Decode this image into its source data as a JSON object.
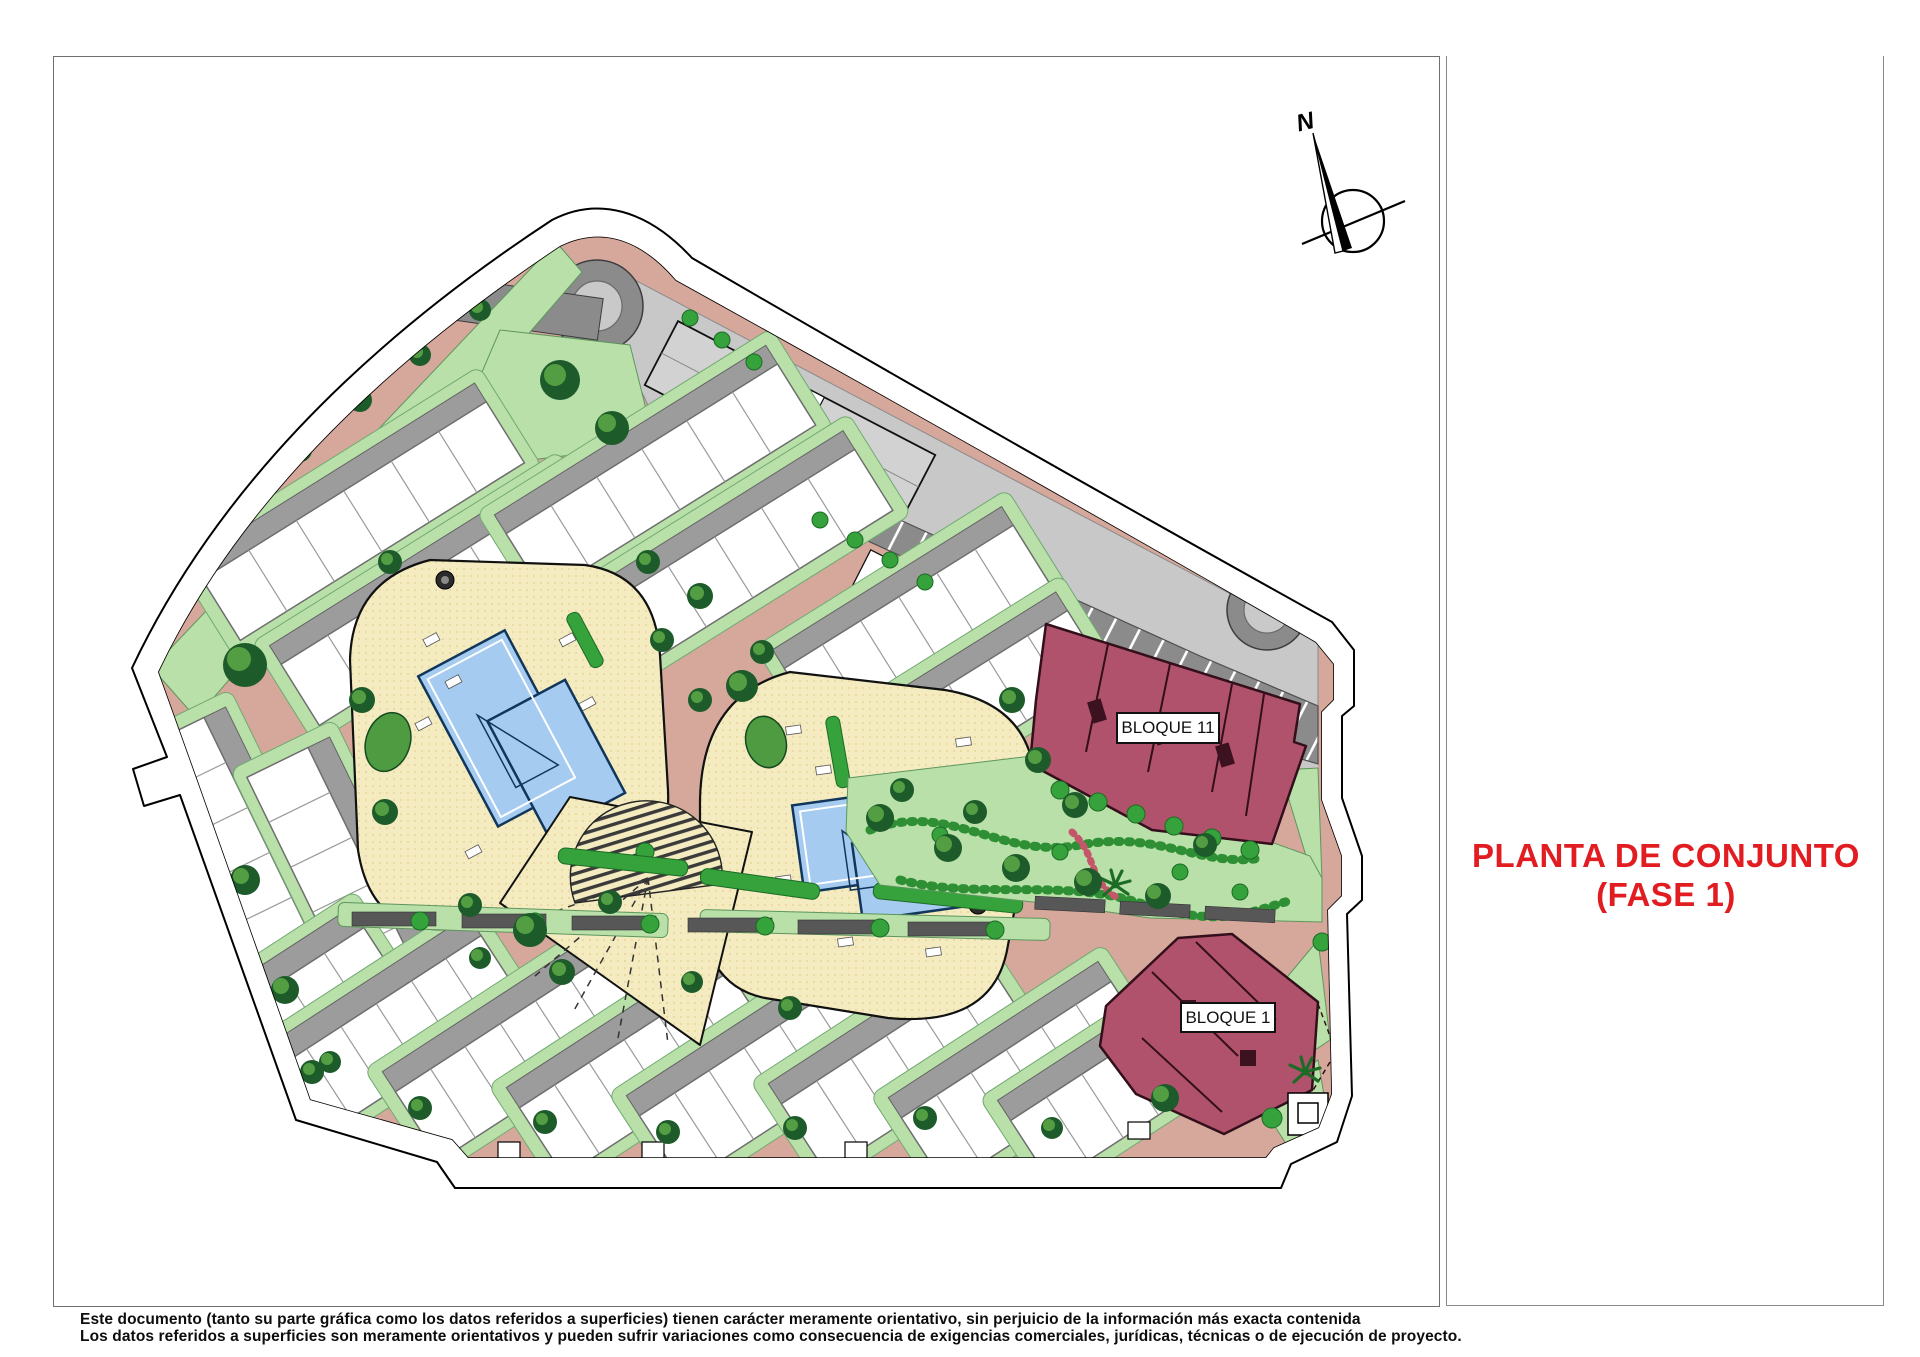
{
  "document": {
    "title_line1": "PLANTA DE CONJUNTO",
    "title_line2": "(FASE 1)",
    "title_color": "#e11d22",
    "disclaimer_line1": "Este documento (tanto su parte gráfica como los datos referidos a superficies) tienen carácter meramente orientativo, sin perjuicio de la información más exacta contenida",
    "disclaimer_line2": "Los datos referidos a superficies son meramente orientativos y pueden sufrir variaciones como consecuencia de exigencias comerciales, jurídicas, técnicas o de ejecución de proyecto."
  },
  "plan": {
    "building_labels": {
      "bloque11": "BLOQUE 11",
      "bloque1": "BLOQUE 1"
    },
    "compass_label": "N",
    "legend_colors": {
      "road_salmon": "#d6a89b",
      "amenity_yellow": "#f4ecc0",
      "lawn_green": "#b8e0a8",
      "pool_blue": "#a6cbf1",
      "phase_building_maroon": "#b0526b",
      "parking_dark_gray": "#8b8b8b",
      "roof_light_gray": "#c8c8c8",
      "townhouse_white": "#ffffff"
    }
  }
}
